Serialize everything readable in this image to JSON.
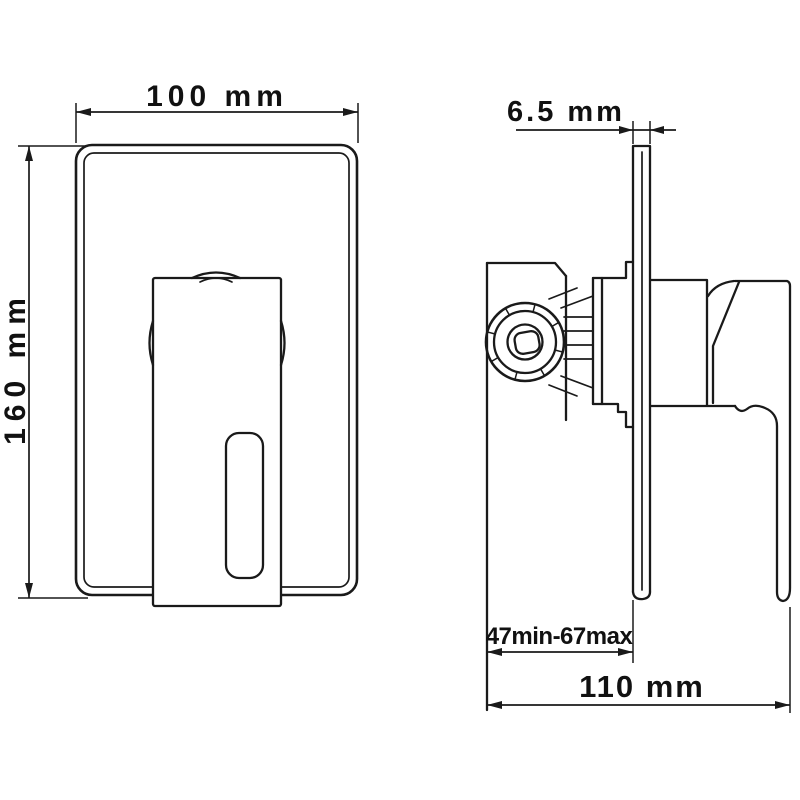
{
  "canvas": {
    "background": "#ffffff",
    "line_color": "#1a1a1a",
    "text_color": "#111111"
  },
  "dims": {
    "front_width": "100 mm",
    "front_height": "160 mm",
    "plate_thickness": "6.5 mm",
    "depth_range": "47min-67max",
    "overall_depth": "110 mm"
  }
}
